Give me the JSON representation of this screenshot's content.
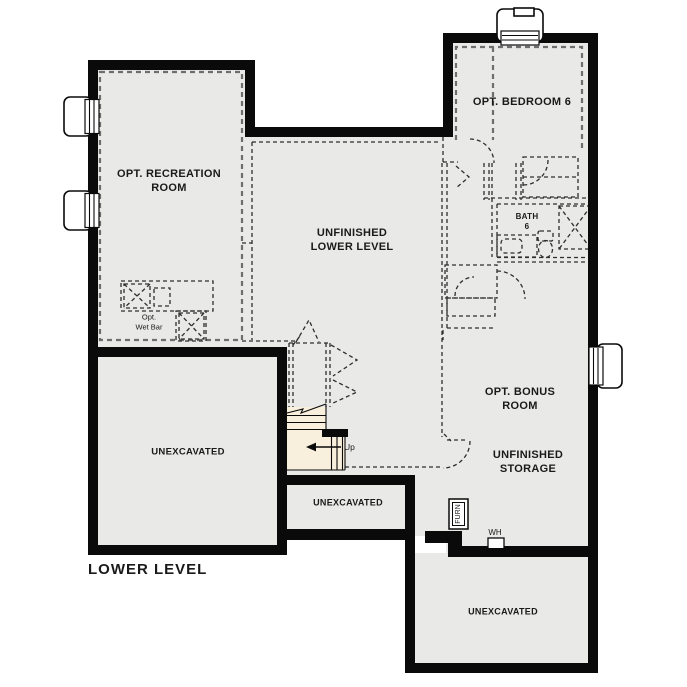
{
  "plan_title": "LOWER LEVEL",
  "rooms": {
    "recreation": {
      "label": "OPT. RECREATION\nROOM"
    },
    "unfinished_lower_level": {
      "label": "UNFINISHED\nLOWER LEVEL"
    },
    "bedroom6": {
      "label": "OPT. BEDROOM 6"
    },
    "bath6": {
      "label": "BATH\n6"
    },
    "bonus": {
      "label": "OPT. BONUS\nROOM"
    },
    "unfinished_storage": {
      "label": "UNFINISHED\nSTORAGE"
    },
    "unexcavated_left": {
      "label": "UNEXCAVATED"
    },
    "unexcavated_middle": {
      "label": "UNEXCAVATED"
    },
    "unexcavated_bottom_right": {
      "label": "UNEXCAVATED"
    },
    "wet_bar": {
      "label": "Opt.\nWet Bar"
    }
  },
  "annotations": {
    "stairs_up": "Up",
    "furnace": "FURN",
    "water_heater": "WH"
  },
  "colors": {
    "background": "#ffffff",
    "floor": "#e9e9e7",
    "stairs_floor": "#f8efdc",
    "walls": "#0a0a0a",
    "optional_dash": "#6e6e6e",
    "detail_dash": "#2e2e2e",
    "text": "#1a1a1a"
  }
}
